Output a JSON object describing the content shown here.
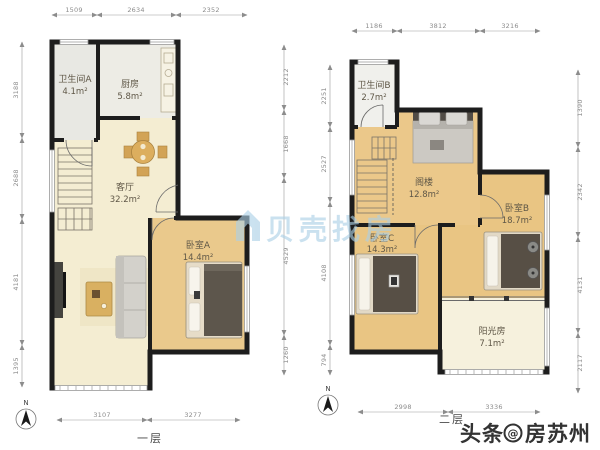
{
  "watermark": {
    "text": "贝壳找房",
    "color": "#abd0e6"
  },
  "footer": {
    "prefix": "头条",
    "at": "@",
    "name": "房苏州"
  },
  "colors": {
    "wall": "#1d1d1d",
    "bedroom_floor": "#eac98c",
    "living_floor": "#f4edd2",
    "watermark_blue": "#abd0e6"
  },
  "floor1": {
    "label": "一层",
    "north": "N",
    "dims_top": [
      "1509",
      "2634",
      "2352"
    ],
    "dims_left": [
      "3188",
      "2688",
      "4181",
      "1395"
    ],
    "dims_right": [
      "2212",
      "1668",
      "4529",
      "1260"
    ],
    "dims_bottom": [
      "3107",
      "3277"
    ],
    "rooms": {
      "bathA": {
        "name": "卫生间A",
        "area": "4.1m²"
      },
      "kitchen": {
        "name": "厨房",
        "area": "5.8m²"
      },
      "living": {
        "name": "客厅",
        "area": "32.2m²"
      },
      "bedroomA": {
        "name": "卧室A",
        "area": "14.4m²"
      }
    }
  },
  "floor2": {
    "label": "二层",
    "north": "N",
    "dims_top": [
      "1186",
      "3812",
      "3216"
    ],
    "dims_left": [
      "2251",
      "2527",
      "4108",
      "794"
    ],
    "dims_right": [
      "1390",
      "2342",
      "4131",
      "2117"
    ],
    "dims_bottom": [
      "2998",
      "3336"
    ],
    "rooms": {
      "bathB": {
        "name": "卫生间B",
        "area": "2.7m²"
      },
      "attic": {
        "name": "阁楼",
        "area": "12.8m²"
      },
      "bedroomB": {
        "name": "卧室B",
        "area": "18.7m²"
      },
      "bedroomC": {
        "name": "卧室C",
        "area": "14.3m²"
      },
      "sunroom": {
        "name": "阳光房",
        "area": "7.1m²"
      }
    }
  }
}
